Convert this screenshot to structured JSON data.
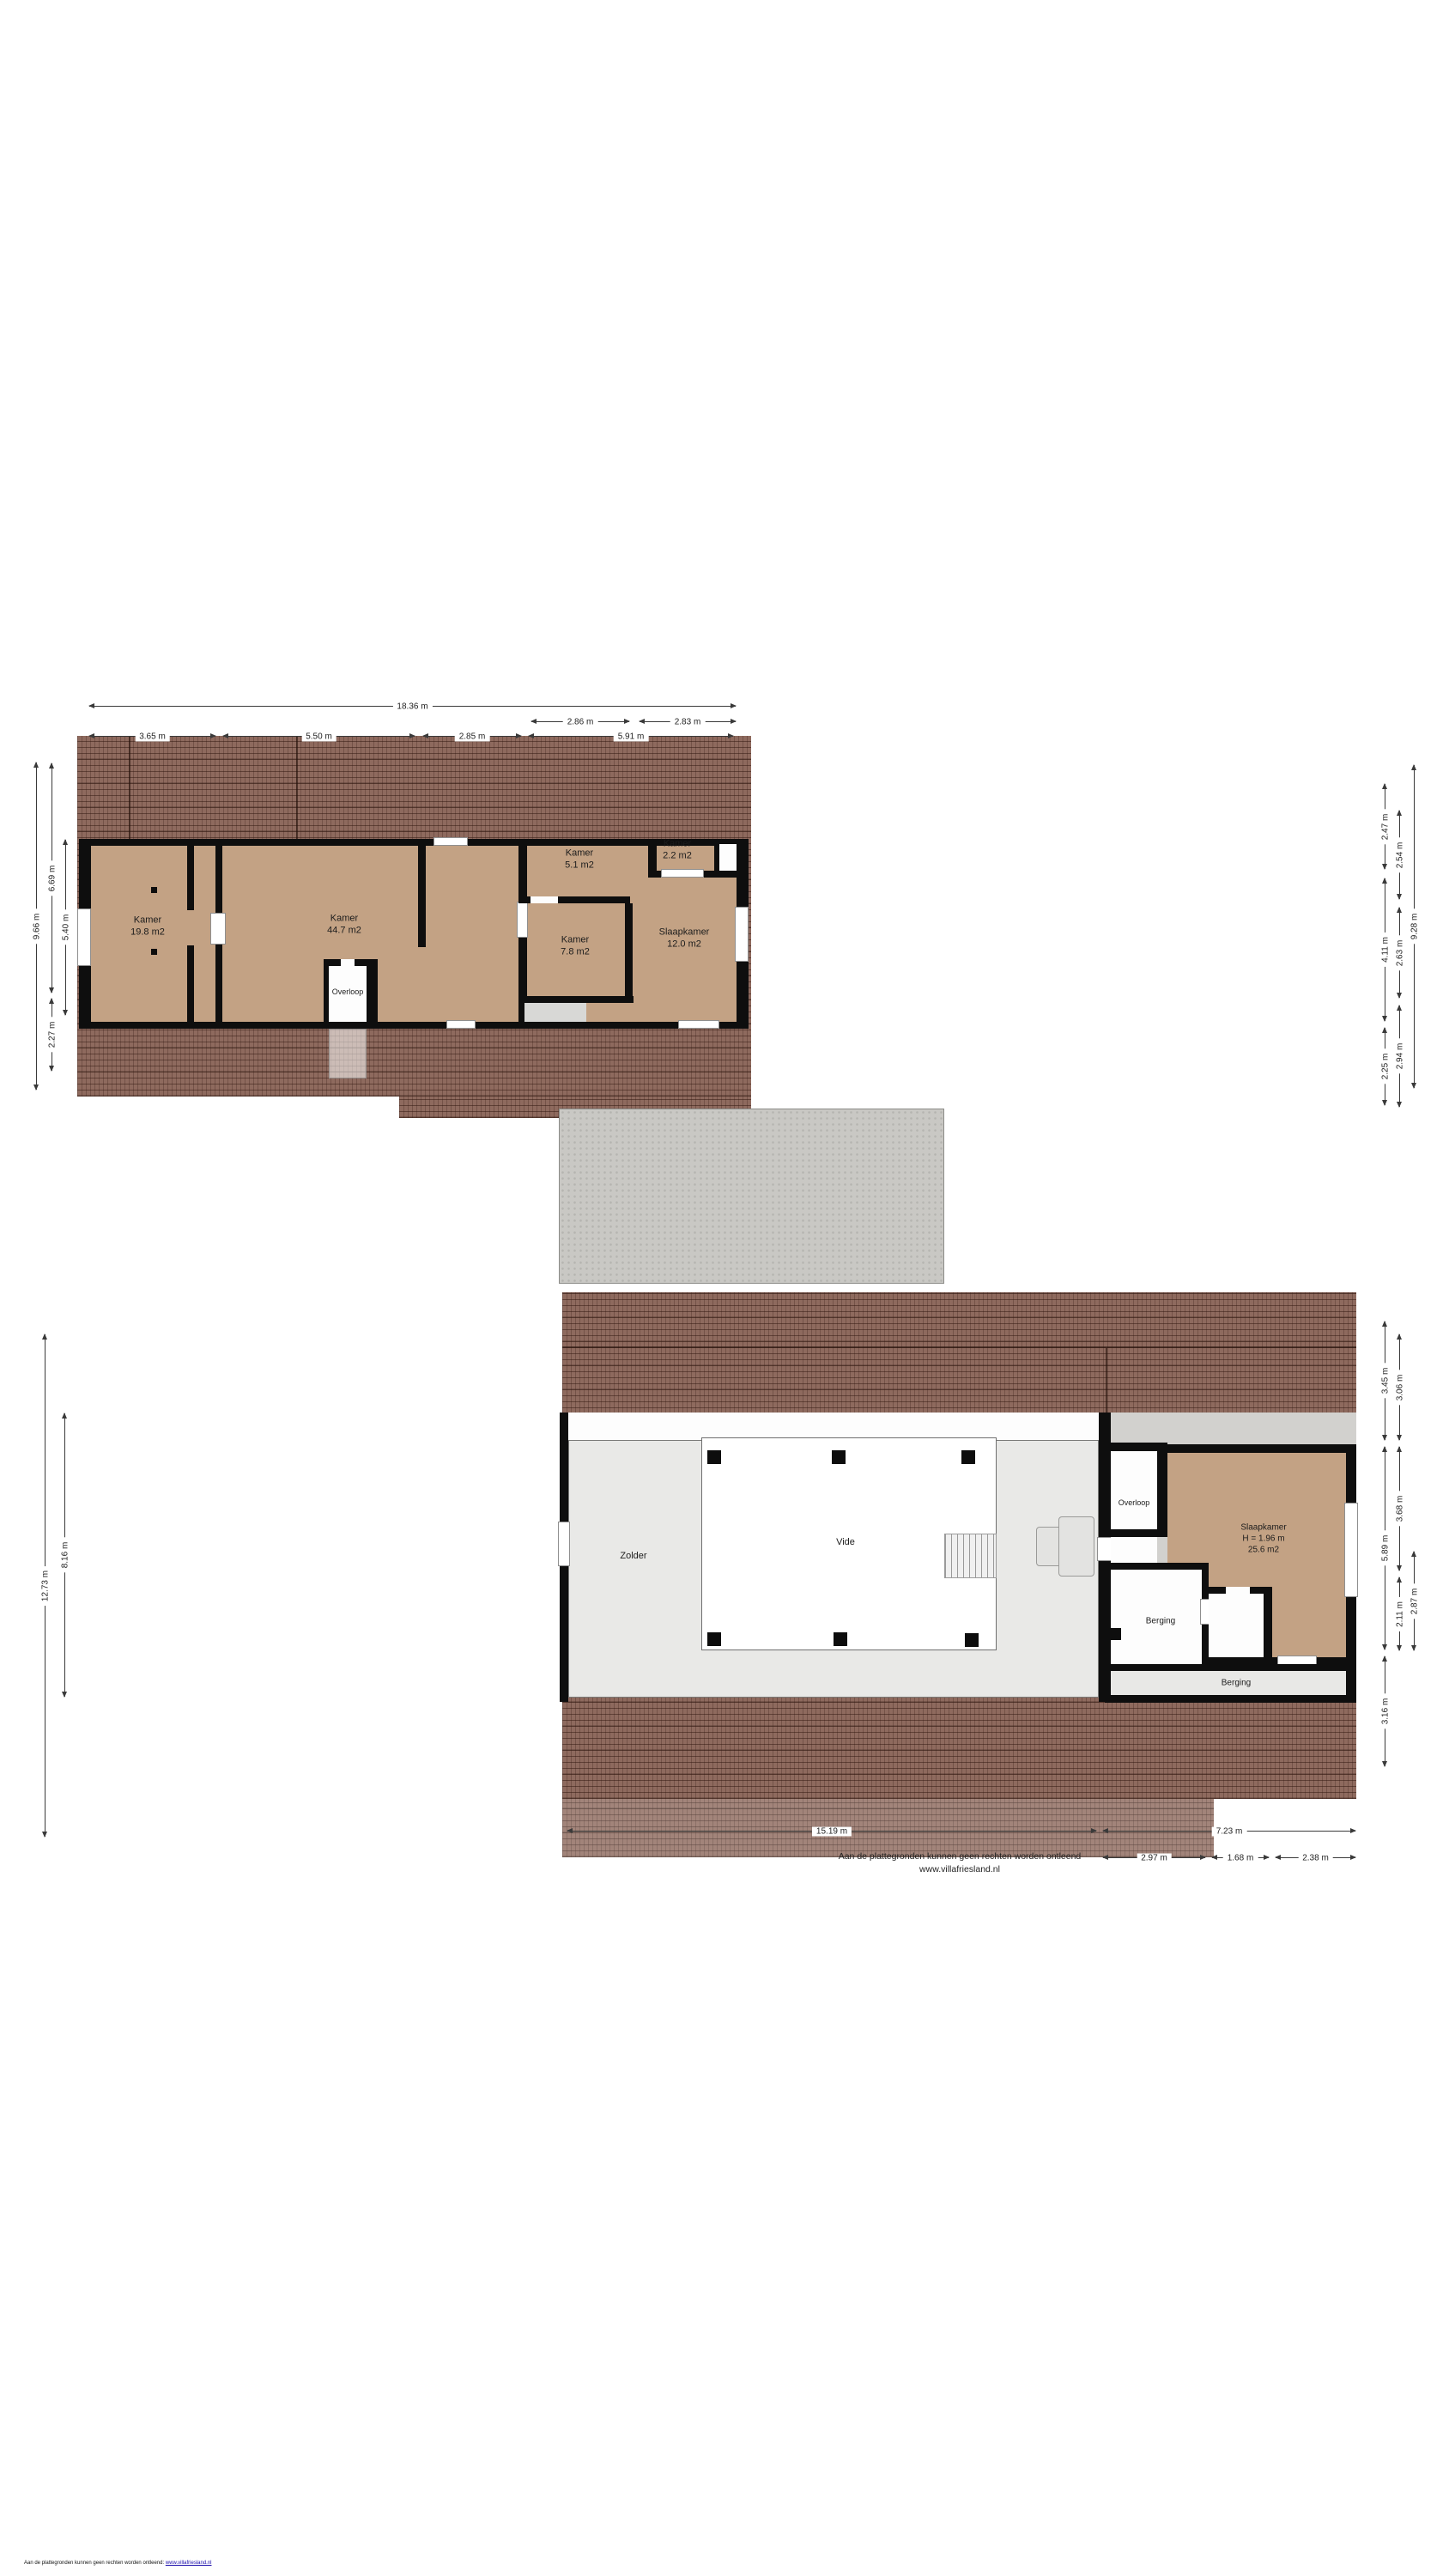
{
  "page": {
    "footer_line1": "Aan de plattegronden kunnen geen rechten worden ontleend",
    "footer_line2": "www.villafriesland.nl",
    "corner_note_text": "Aan de plattegronden kunnen geen rechten worden ontleend:",
    "corner_note_link": "www.villafriesland.nl"
  },
  "colors": {
    "roof_brown": "#8e6a5e",
    "floor_tan": "#c3a284",
    "interior_gray": "#e9e9e7",
    "extension_gray": "#d2d1ce",
    "concrete_gray": "#c9c8c4",
    "wall_black": "#0e0e0e",
    "dim_line": "#3a3a3a",
    "link_blue": "#1a0dab"
  },
  "upper_plan": {
    "rooms": {
      "kamer1": {
        "name": "Kamer",
        "area": "19.8 m2"
      },
      "kamer2": {
        "name": "Kamer",
        "area": "44.7 m2"
      },
      "kamer3": {
        "name": "Kamer",
        "area": "5.1 m2"
      },
      "kamer4": {
        "name": "Kamer",
        "area": "2.2 m2"
      },
      "kamer5": {
        "name": "Kamer",
        "area": "7.8 m2"
      },
      "slaapkamer": {
        "name": "Slaapkamer",
        "area": "12.0 m2"
      },
      "overloop": {
        "name": "Overloop"
      }
    },
    "dims": {
      "top_row1": [
        "18.36 m"
      ],
      "top_row2": [
        "2.86 m",
        "2.83 m"
      ],
      "top_row3": [
        "3.65 m",
        "5.50 m",
        "2.85 m",
        "5.91 m"
      ],
      "left": [
        "9.66 m",
        "6.69 m",
        "5.40 m",
        "2.27 m"
      ],
      "right_col1": [
        "2.47 m",
        "4.11 m",
        "2.25 m"
      ],
      "right_col2": [
        "2.54 m",
        "2.63 m",
        "2.94 m"
      ],
      "right_col3": [
        "9.28 m"
      ]
    }
  },
  "lower_plan": {
    "rooms": {
      "zolder": {
        "name": "Zolder"
      },
      "vide": {
        "name": "Vide"
      },
      "overloop": {
        "name": "Overloop"
      },
      "slaapkamer": {
        "name": "Slaapkamer",
        "height": "H = 1.96 m",
        "area": "25.6 m2"
      },
      "berging1": {
        "name": "Berging"
      },
      "berging2": {
        "name": "Berging"
      }
    },
    "dims": {
      "left": [
        "12.73 m",
        "8.16 m"
      ],
      "right_col1": [
        "3.45 m",
        "5.89 m",
        "3.16 m"
      ],
      "right_col2": [
        "3.06 m",
        "3.68 m",
        "2.11 m"
      ],
      "right_col3": [
        "2.87 m"
      ],
      "bottom_row1": [
        "15.19 m",
        "7.23 m"
      ],
      "bottom_row2": [
        "2.97 m",
        "1.68 m",
        "2.38 m"
      ]
    }
  }
}
